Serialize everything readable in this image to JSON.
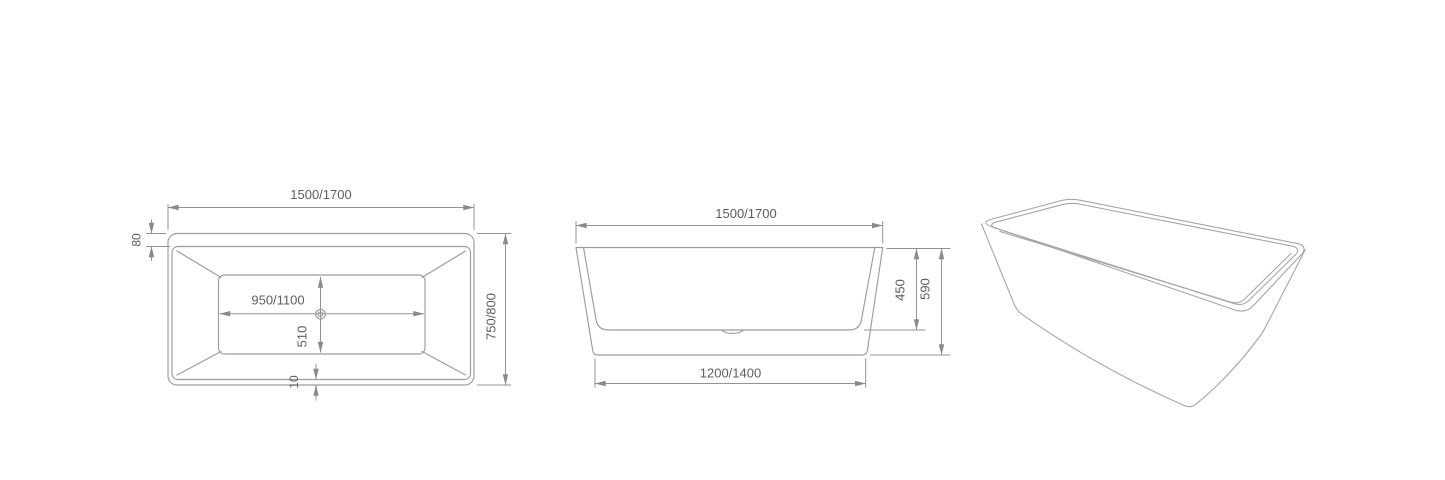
{
  "drawing": {
    "background_color": "#ffffff",
    "edge_line_color": "#9c9c9c",
    "dimension_line_color": "#949494",
    "text_color": "#5d5d5d"
  },
  "icons": {
    "drain": "concentric-circles"
  },
  "dims": {
    "top": {
      "overall_length": "1500/1700",
      "overall_width": "750/800",
      "front_rim": "80",
      "back_rim": "10",
      "basin_floor_length": "950/1100",
      "basin_floor_width": "510"
    },
    "front": {
      "rim_length": "1500/1700",
      "base_length": "1200/1400",
      "inner_depth": "450",
      "overall_height": "590"
    }
  }
}
